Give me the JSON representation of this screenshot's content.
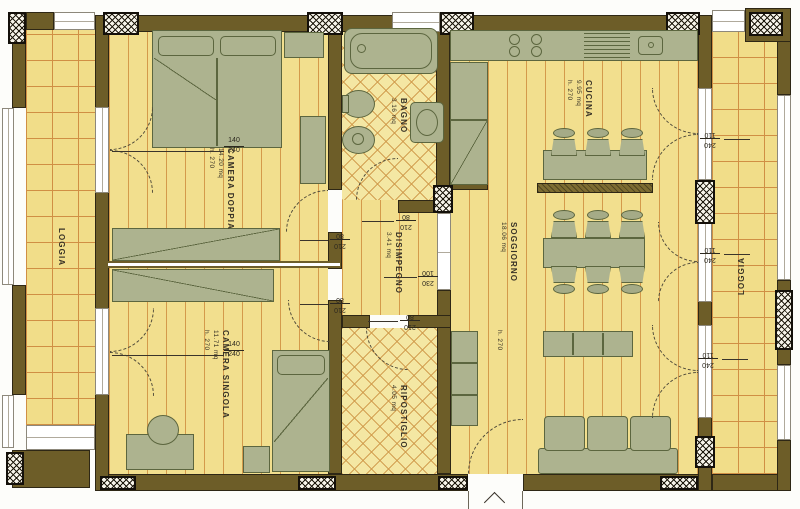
{
  "plan_title": "Apartment floor plan",
  "rooms": {
    "loggia_left": {
      "name": "LOGGIA"
    },
    "camera_doppia": {
      "name": "CAMERA DOPPIA",
      "area": "14.20 mq",
      "height": "h. 270"
    },
    "bagno": {
      "name": "BAGNO",
      "area": "3.16 mq"
    },
    "cucina": {
      "name": "CUCINA",
      "area": "9.95 mq",
      "height": "h. 270"
    },
    "disimpegno": {
      "name": "DISIMPEGNO",
      "area": "3.41 mq"
    },
    "soggiorno": {
      "name": "SOGGIORNO",
      "area": "18.06 mq",
      "height": "h. 270"
    },
    "camera_singola": {
      "name": "CAMERA SINGOLA",
      "area": "11.71 mq",
      "height": "h. 270"
    },
    "ripostiglio": {
      "name": "RIPOSTIGLIO",
      "area": "4.05 mq"
    },
    "loggia_right": {
      "name": "LOGGIA"
    }
  },
  "dimensions": {
    "window_left_top": {
      "w": "140",
      "h": "240"
    },
    "window_left_bottom": {
      "w": "140",
      "h": "240"
    },
    "door_bagno": {
      "w": "80",
      "h": "210"
    },
    "door_camera_doppia": {
      "w": "80",
      "h": "210"
    },
    "door_camera_singola": {
      "w": "80",
      "h": "210"
    },
    "door_ripostiglio": {
      "w": "80",
      "h": "210"
    },
    "passage_soggiorno": {
      "w": "230",
      "h": "100"
    },
    "door_loggia_cucina": {
      "w": "240",
      "h": "110"
    },
    "door_loggia_soggiorno_up": {
      "w": "240",
      "h": "110"
    },
    "door_loggia_soggiorno_dn": {
      "w": "240",
      "h": "110"
    }
  },
  "colors": {
    "wall": "#6d5d28",
    "floor": "#f2df8e",
    "floor_line": "#d49a4b",
    "furniture": "#adb38f",
    "furniture_outline": "#5c663f",
    "paper": "#ffffff"
  }
}
